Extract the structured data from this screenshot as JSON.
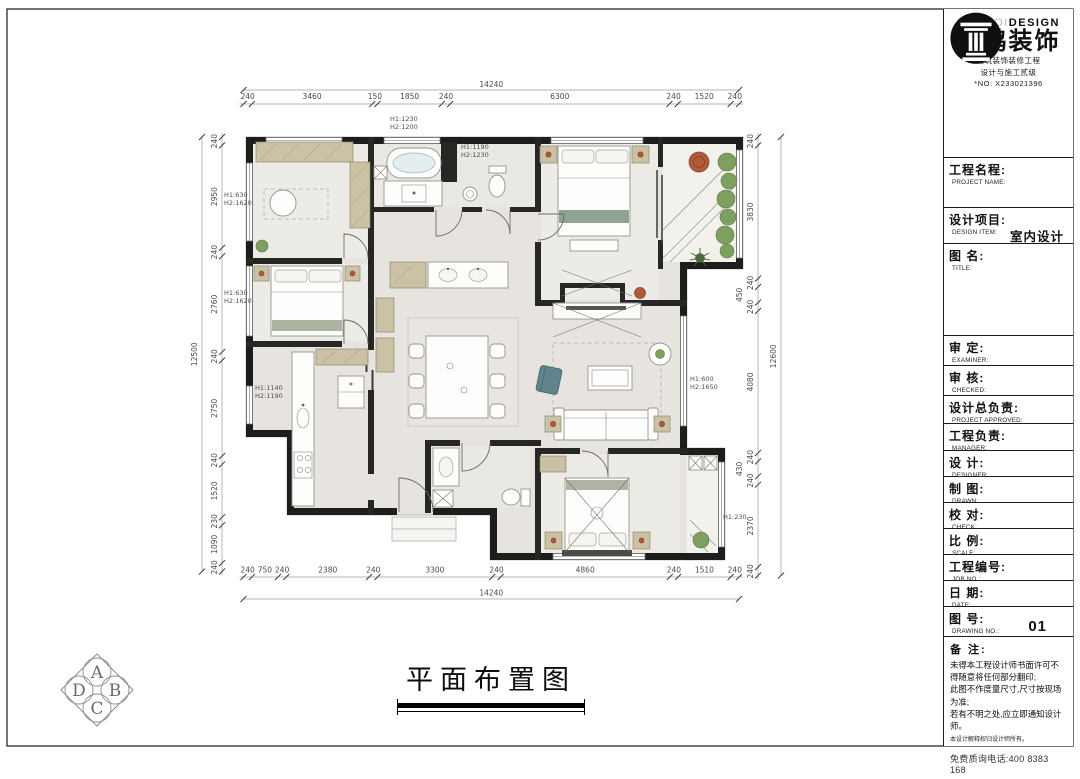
{
  "colors": {
    "wall": "#1d1d1b",
    "wood": "#cbc1a5",
    "plant": "#7e9f60",
    "terracotta": "#b2593c",
    "teal": "#5f8490",
    "floor": "#e7e4df"
  },
  "brand": {
    "name_light": "NANHOI",
    "name_bold": "DESIGN",
    "name_cn": "南鸿装饰",
    "subtitle1": "建筑装饰装修工程",
    "subtitle2": "设计与施工贰级",
    "reg_no": "*NO: X233021396"
  },
  "titleblock": {
    "rows": [
      {
        "cn": "工程名程:",
        "en": "PROJECT NAME:",
        "value": ""
      },
      {
        "cn": "设计项目:",
        "en": "DESIGN ITEM:",
        "value": "室内设计"
      },
      {
        "cn": "图  名:",
        "en": "TITLE:",
        "value": ""
      },
      {
        "cn": "审  定:",
        "en": "EXAMINER:",
        "value": ""
      },
      {
        "cn": "审  核:",
        "en": "CHECKED:",
        "value": ""
      },
      {
        "cn": "设计总负责:",
        "en": "PROJECT APPROVED:",
        "value": ""
      },
      {
        "cn": "工程负责:",
        "en": "MANAGER:",
        "value": ""
      },
      {
        "cn": "设  计:",
        "en": "DESIGNER:",
        "value": ""
      },
      {
        "cn": "制  图:",
        "en": "DRAWN:",
        "value": ""
      },
      {
        "cn": "校  对:",
        "en": "CHECK:",
        "value": ""
      },
      {
        "cn": "比  例:",
        "en": "SCALE:",
        "value": ""
      },
      {
        "cn": "工程编号:",
        "en": "JOB  NO.:",
        "value": ""
      },
      {
        "cn": "日  期:",
        "en": "DATE:",
        "value": ""
      },
      {
        "cn": "图  号:",
        "en": "DRAWING NO.:",
        "value": "01"
      }
    ],
    "notes_title": "备 注:",
    "notes": [
      "未得本工程设计师书面许可不得随意将任何部分翻印;",
      "此图不作度量尺寸,尺寸按现场为准;",
      "若有不明之处,应立即通知设计师。"
    ],
    "notes_small": "本设计解释权归设计师所有。",
    "phone": "免费质询电话:400 8383 168"
  },
  "plan": {
    "title": "平面布置图",
    "dims": {
      "top": {
        "total": "14240",
        "segments": [
          240,
          3460,
          150,
          1850,
          240,
          6300,
          240,
          1520,
          240
        ]
      },
      "bottom": {
        "total": "14240",
        "segments": [
          240,
          750,
          240,
          2380,
          240,
          3300,
          240,
          4860,
          240,
          1510,
          240
        ]
      },
      "left": {
        "total": "12500",
        "segments": [
          240,
          2950,
          240,
          2760,
          240,
          2750,
          240,
          1520,
          230,
          1090,
          240
        ]
      },
      "right": {
        "total": "12600",
        "segments": [
          240,
          3830,
          240,
          450,
          240,
          4080,
          240,
          430,
          240,
          2370,
          240
        ]
      }
    },
    "height_labels": [
      {
        "l1": "H1:1230",
        "l2": "H2:1200"
      },
      {
        "l1": "H1:1190",
        "l2": "H2:1230"
      },
      {
        "l1": "H1:630",
        "l2": "H2:1620"
      },
      {
        "l1": "H1:630",
        "l2": "H2:1620"
      },
      {
        "l1": "H1:1140",
        "l2": "H2:1190"
      },
      {
        "l1": "H1:600",
        "l2": "H2:1650"
      },
      {
        "l1": "H1:230",
        "l2": ""
      }
    ]
  },
  "compass": {
    "letters": [
      "A",
      "B",
      "C",
      "D"
    ]
  }
}
